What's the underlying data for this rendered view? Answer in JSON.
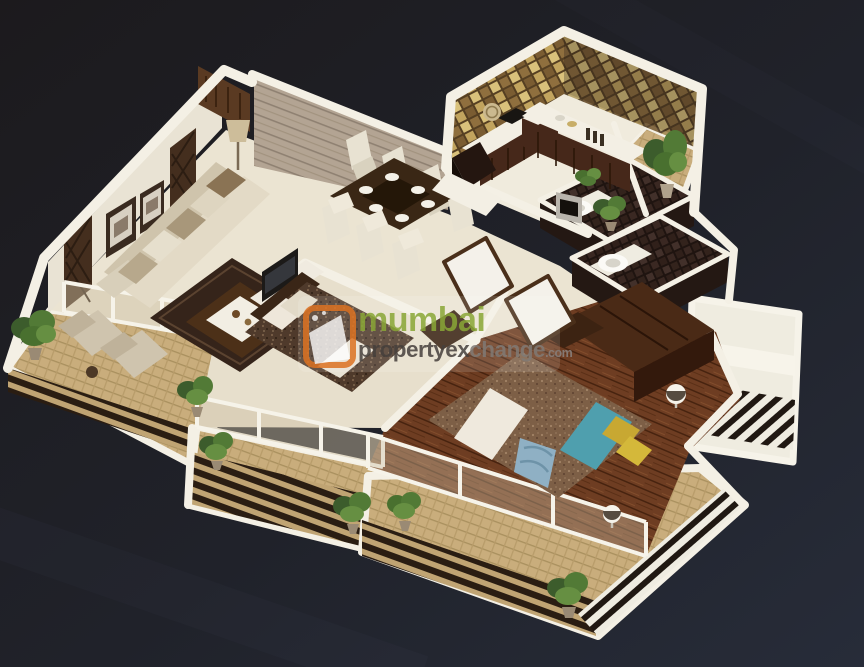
{
  "watermark": {
    "brand_line1": "mumbai",
    "brand_line2a": "propertyex",
    "brand_line2b": "change",
    "brand_tld": ".com",
    "logo_color": "#dd7527",
    "line1_color": "#8ca93b",
    "line2a_color": "#4a4440",
    "line2b_color": "#837d78",
    "tld_color": "#8a8380"
  },
  "scene": {
    "type": "3d-isometric-apartment-floor-plan",
    "rooms": [
      "entrance-foyer",
      "living-room",
      "dining-area",
      "kitchen",
      "utility-balcony",
      "bathroom-1",
      "bathroom-2",
      "bedroom-1",
      "master-bedroom",
      "living-balcony",
      "bedroom-balcony",
      "master-balcony",
      "side-balcony"
    ],
    "colors": {
      "background_start": "#1c1a1d",
      "background_end": "#272c39",
      "wall": "#f4f0e5",
      "wall_face": "#e9e3d4",
      "floor": "#ebe4d2",
      "wood_floor": "#6e3d22",
      "dark_tile": "#36261f",
      "mosaic_gold": "#b2935a",
      "plank_wall": "#b3a493",
      "sofa": "#ddd3bd",
      "bed1_duvet": "#4f3a2b",
      "bed2_duvet": "#7d5f46",
      "teal_runner": "#4f9fae",
      "yellow_pillow": "#c8a832",
      "foliage": "#527a36",
      "railing": "#2a1d12",
      "balcony_floor": "#c9ad7c"
    }
  }
}
